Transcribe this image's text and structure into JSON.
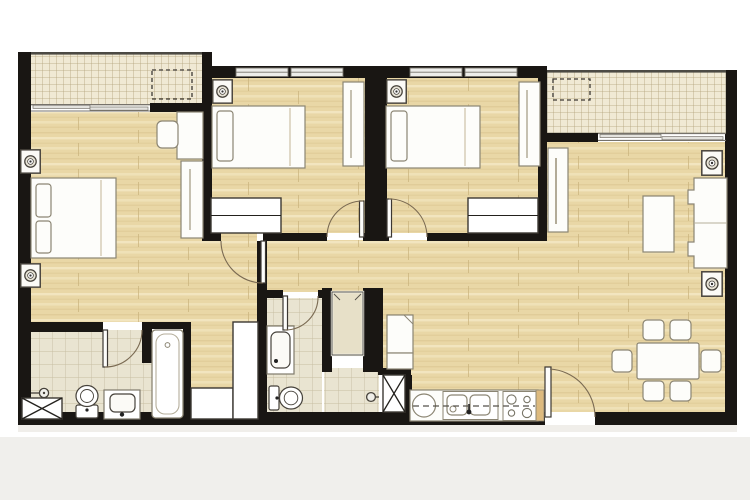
{
  "colors": {
    "page": "#ffffff",
    "band": "#f0efec",
    "wall": "#191613",
    "wood": "#e9d7a6",
    "woodDark": "#d9c38e",
    "woodLight": "#f4e8c5",
    "woodJoint": "#c9b27c",
    "balcony": "#f0e9d4",
    "balconyGrid": "#b2a279",
    "tile": "#e9e4d1",
    "tileGrid": "#c6bea1",
    "closet": "#e7e0c8",
    "furnFill": "#fdfdfa",
    "furnStroke": "#8b8573",
    "darkStroke": "#3c3833",
    "arc": "#7a6a52",
    "windowLine": "#76726b",
    "windowFill": "#ededea",
    "railing": "#4c4a44",
    "counterEnd": "#ddba7e",
    "shadow": "#e3e0d9"
  },
  "plan": {
    "regions": [
      "master-bedroom",
      "bedroom-2",
      "bedroom-3",
      "living-room",
      "dining-area",
      "kitchen",
      "bathroom-1",
      "bathroom-2",
      "walk-in-wardrobe",
      "storage-room",
      "corridor",
      "balcony-left",
      "balcony-right"
    ],
    "furniture": [
      "double-bed",
      "single-bed",
      "nightstand-lamp",
      "wardrobe",
      "wardrobe-rail-closet",
      "desk",
      "desk-chair",
      "sofa",
      "coffee-table",
      "tv-cabinet",
      "side-table-lamp",
      "dining-table",
      "dining-chair",
      "kitchen-counter",
      "round-sink",
      "double-sink",
      "cooktop-4-burner",
      "refrigerator",
      "bathtub",
      "toilet",
      "wash-basin",
      "shower-head",
      "service-shaft",
      "linen-closet",
      "sliding-door",
      "window",
      "door-swing",
      "ac-outdoor-unit"
    ],
    "counts": {
      "bedrooms": 3,
      "bathrooms": 2,
      "balconies": 2,
      "dining_chairs": 6
    }
  }
}
